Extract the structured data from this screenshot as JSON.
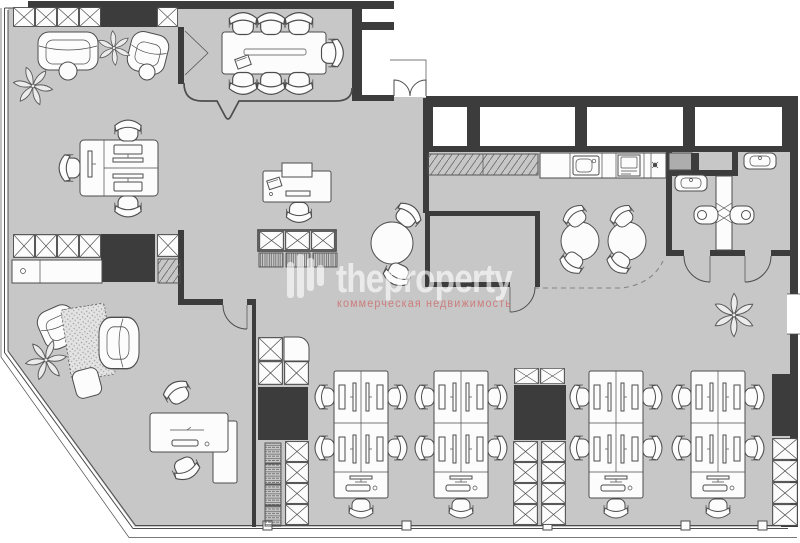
{
  "watermark": {
    "logo": "equalizer-bars-icon",
    "brand": "theproperty",
    "subtitle": "коммерческая недвижимость"
  },
  "palette": {
    "outside": "#ffffff",
    "floor": "#c7c7c7",
    "wall": "#3c3c3c",
    "line": "#4d4d4d",
    "furniture": "#fcfcfc",
    "accent_shaft": "#adadad",
    "watermark_text": "rgba(255,255,255,0.62)",
    "watermark_subtitle": "rgba(204,108,108,0.8)"
  },
  "plan_icons": [
    "meeting-table-icon",
    "office-chair-icon",
    "sofa-icon",
    "armchair-icon",
    "plant-icon",
    "workstation-pod-icon",
    "storage-xbox-icon",
    "bookshelf-icon",
    "toilet-icon",
    "sink-icon",
    "stove-icon",
    "round-table-icon",
    "door-swing-icon",
    "window-icon",
    "rug-icon",
    "coat-rack-icon"
  ]
}
